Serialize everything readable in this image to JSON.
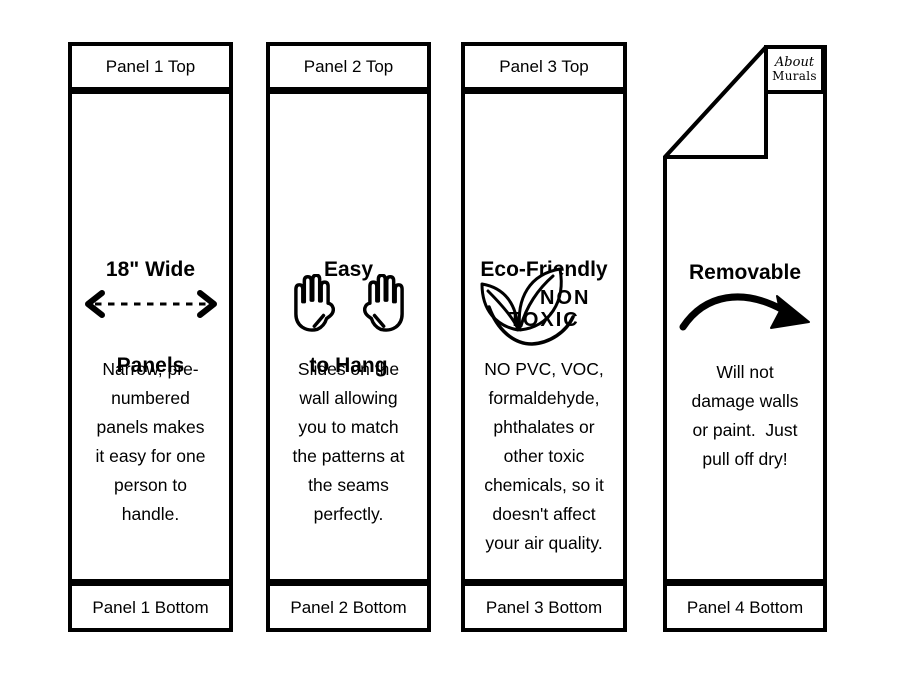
{
  "canvas": {
    "background": "#ffffff",
    "ink": "#000000"
  },
  "brand": {
    "name_line1": "About",
    "name_line2": "Murals"
  },
  "panels": [
    {
      "top_label": "Panel 1 Top",
      "bottom_label": "Panel 1 Bottom",
      "heading_lines": [
        "18\" Wide",
        "Panels"
      ],
      "icon": "double-headed-dashed-arrow",
      "body_lines": [
        "Narrow, pre-",
        "numbered",
        "panels makes",
        "it easy for one",
        "person to",
        "handle."
      ]
    },
    {
      "top_label": "Panel 2 Top",
      "bottom_label": "Panel 2 Bottom",
      "heading_lines": [
        "Easy",
        "to Hang"
      ],
      "icon": "two-open-hands",
      "body_lines": [
        "Slides on the",
        "wall allowing",
        "you to match",
        "the patterns at",
        "the seams",
        "perfectly."
      ]
    },
    {
      "top_label": "Panel 3 Top",
      "bottom_label": "Panel 3 Bottom",
      "heading_lines": [
        "Eco-Friendly"
      ],
      "icon": "non-toxic-leaves",
      "icon_text_lines": [
        "NON",
        "TOXIC"
      ],
      "body_lines": [
        "NO PVC, VOC,",
        "formaldehyde,",
        "phthalates or",
        "other toxic",
        "chemicals, so it",
        "doesn't affect",
        "your air quality."
      ]
    },
    {
      "bottom_label": "Panel 4 Bottom",
      "heading_lines": [
        "Removable"
      ],
      "icon": "curved-peel-arrow",
      "body_lines": [
        "Will not",
        "damage walls",
        "or paint.  Just",
        "pull off dry!"
      ]
    }
  ]
}
